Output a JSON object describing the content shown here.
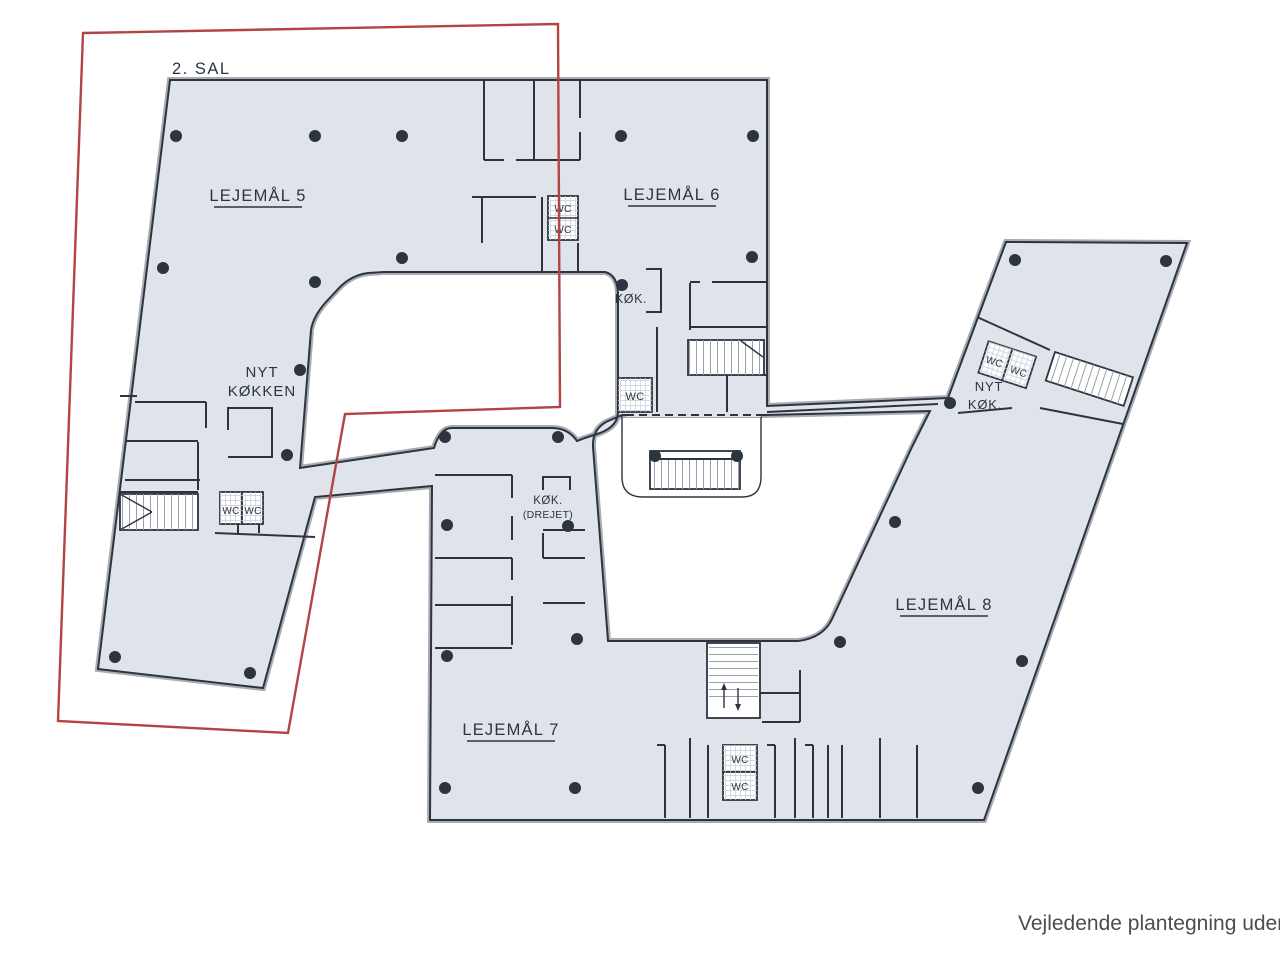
{
  "plan": {
    "floor_label": "2. SAL",
    "caption": "Vejledende plantegning uden a",
    "colors": {
      "floor_fill": "#dfe3ea",
      "wall": "#2d3440",
      "outer_band": "#a8adb4",
      "hatch": "#9aa1ac",
      "wc_hatch": "#c7ccd6",
      "highlight": "#b24444",
      "caption_text": "#4d4d4d"
    },
    "units": {
      "u5": "LEJEMÅL 5",
      "u6": "LEJEMÅL 6",
      "u7": "LEJEMÅL 7",
      "u8": "LEJEMÅL 8"
    },
    "rooms": {
      "wc": "WC",
      "kok": "KØK.",
      "nyt": "NYT",
      "kokken": "KØKKEN",
      "drejet": "(DREJET)"
    }
  }
}
